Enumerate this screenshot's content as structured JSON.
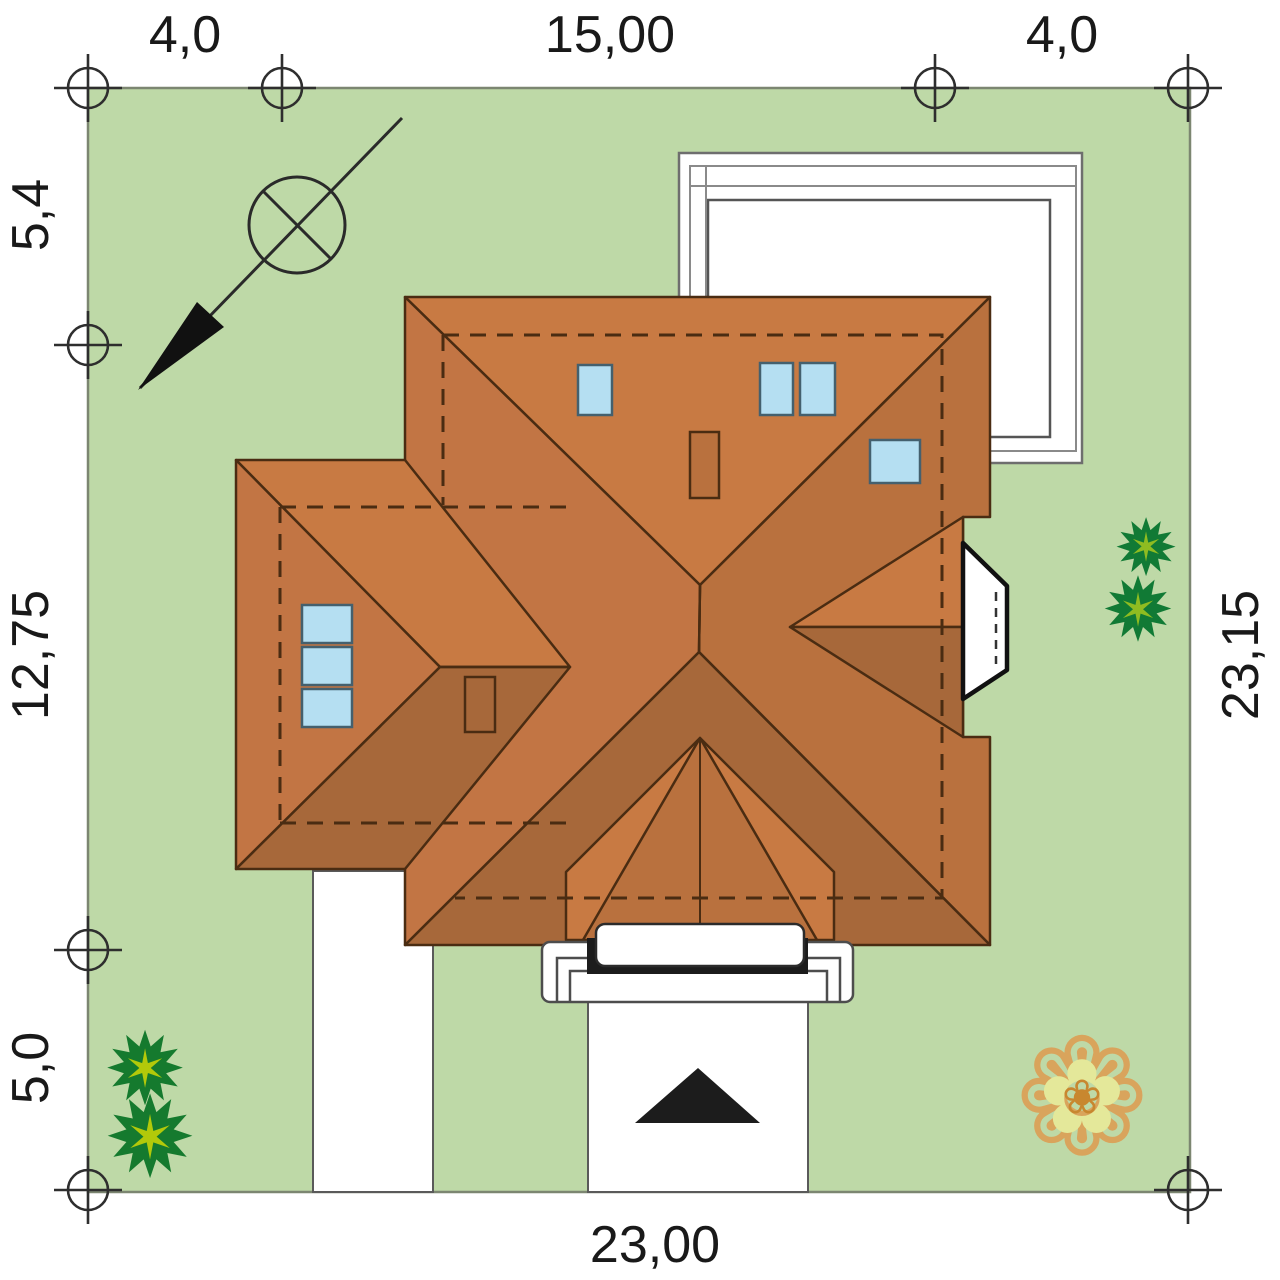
{
  "document": {
    "type": "house-site-plan",
    "description": "top view plot plan with hip roof house, terrace, driveway and garden"
  },
  "colors": {
    "plot_green": "#bed9a7",
    "roof_light": "#c87a43",
    "roof_medium": "#b9713e",
    "roof_west": "#c27544",
    "roof_dark": "#a7683a",
    "skylight_blue": "#b5dff2",
    "path_white": "#ffffff",
    "line_dark": "#4a2c12",
    "entrance_black": "#1c1c1c",
    "bush_dark_green": "#157a2e",
    "bush_light_green": "#b2c90a",
    "plant_dark_green": "#117a35",
    "plant_light_green": "#8fbc21",
    "leaf_tan": "#d9a45c",
    "leaf_pale": "#e4e89a",
    "leaf_core": "#c8872f"
  },
  "dimensions": {
    "top_left": "4,0",
    "top_center": "15,00",
    "top_right": "4,0",
    "left_top": "5,4",
    "left_middle": "12,75",
    "left_bottom": "5,0",
    "right_side": "23,15",
    "bottom": "23,00"
  },
  "icons": {
    "bush_spiky": "✹",
    "bush_spiky_inner": "✶",
    "bush_leafy_outer": "❁",
    "bush_leafy_inner": "✿",
    "bush_leafy_core": "❀"
  }
}
